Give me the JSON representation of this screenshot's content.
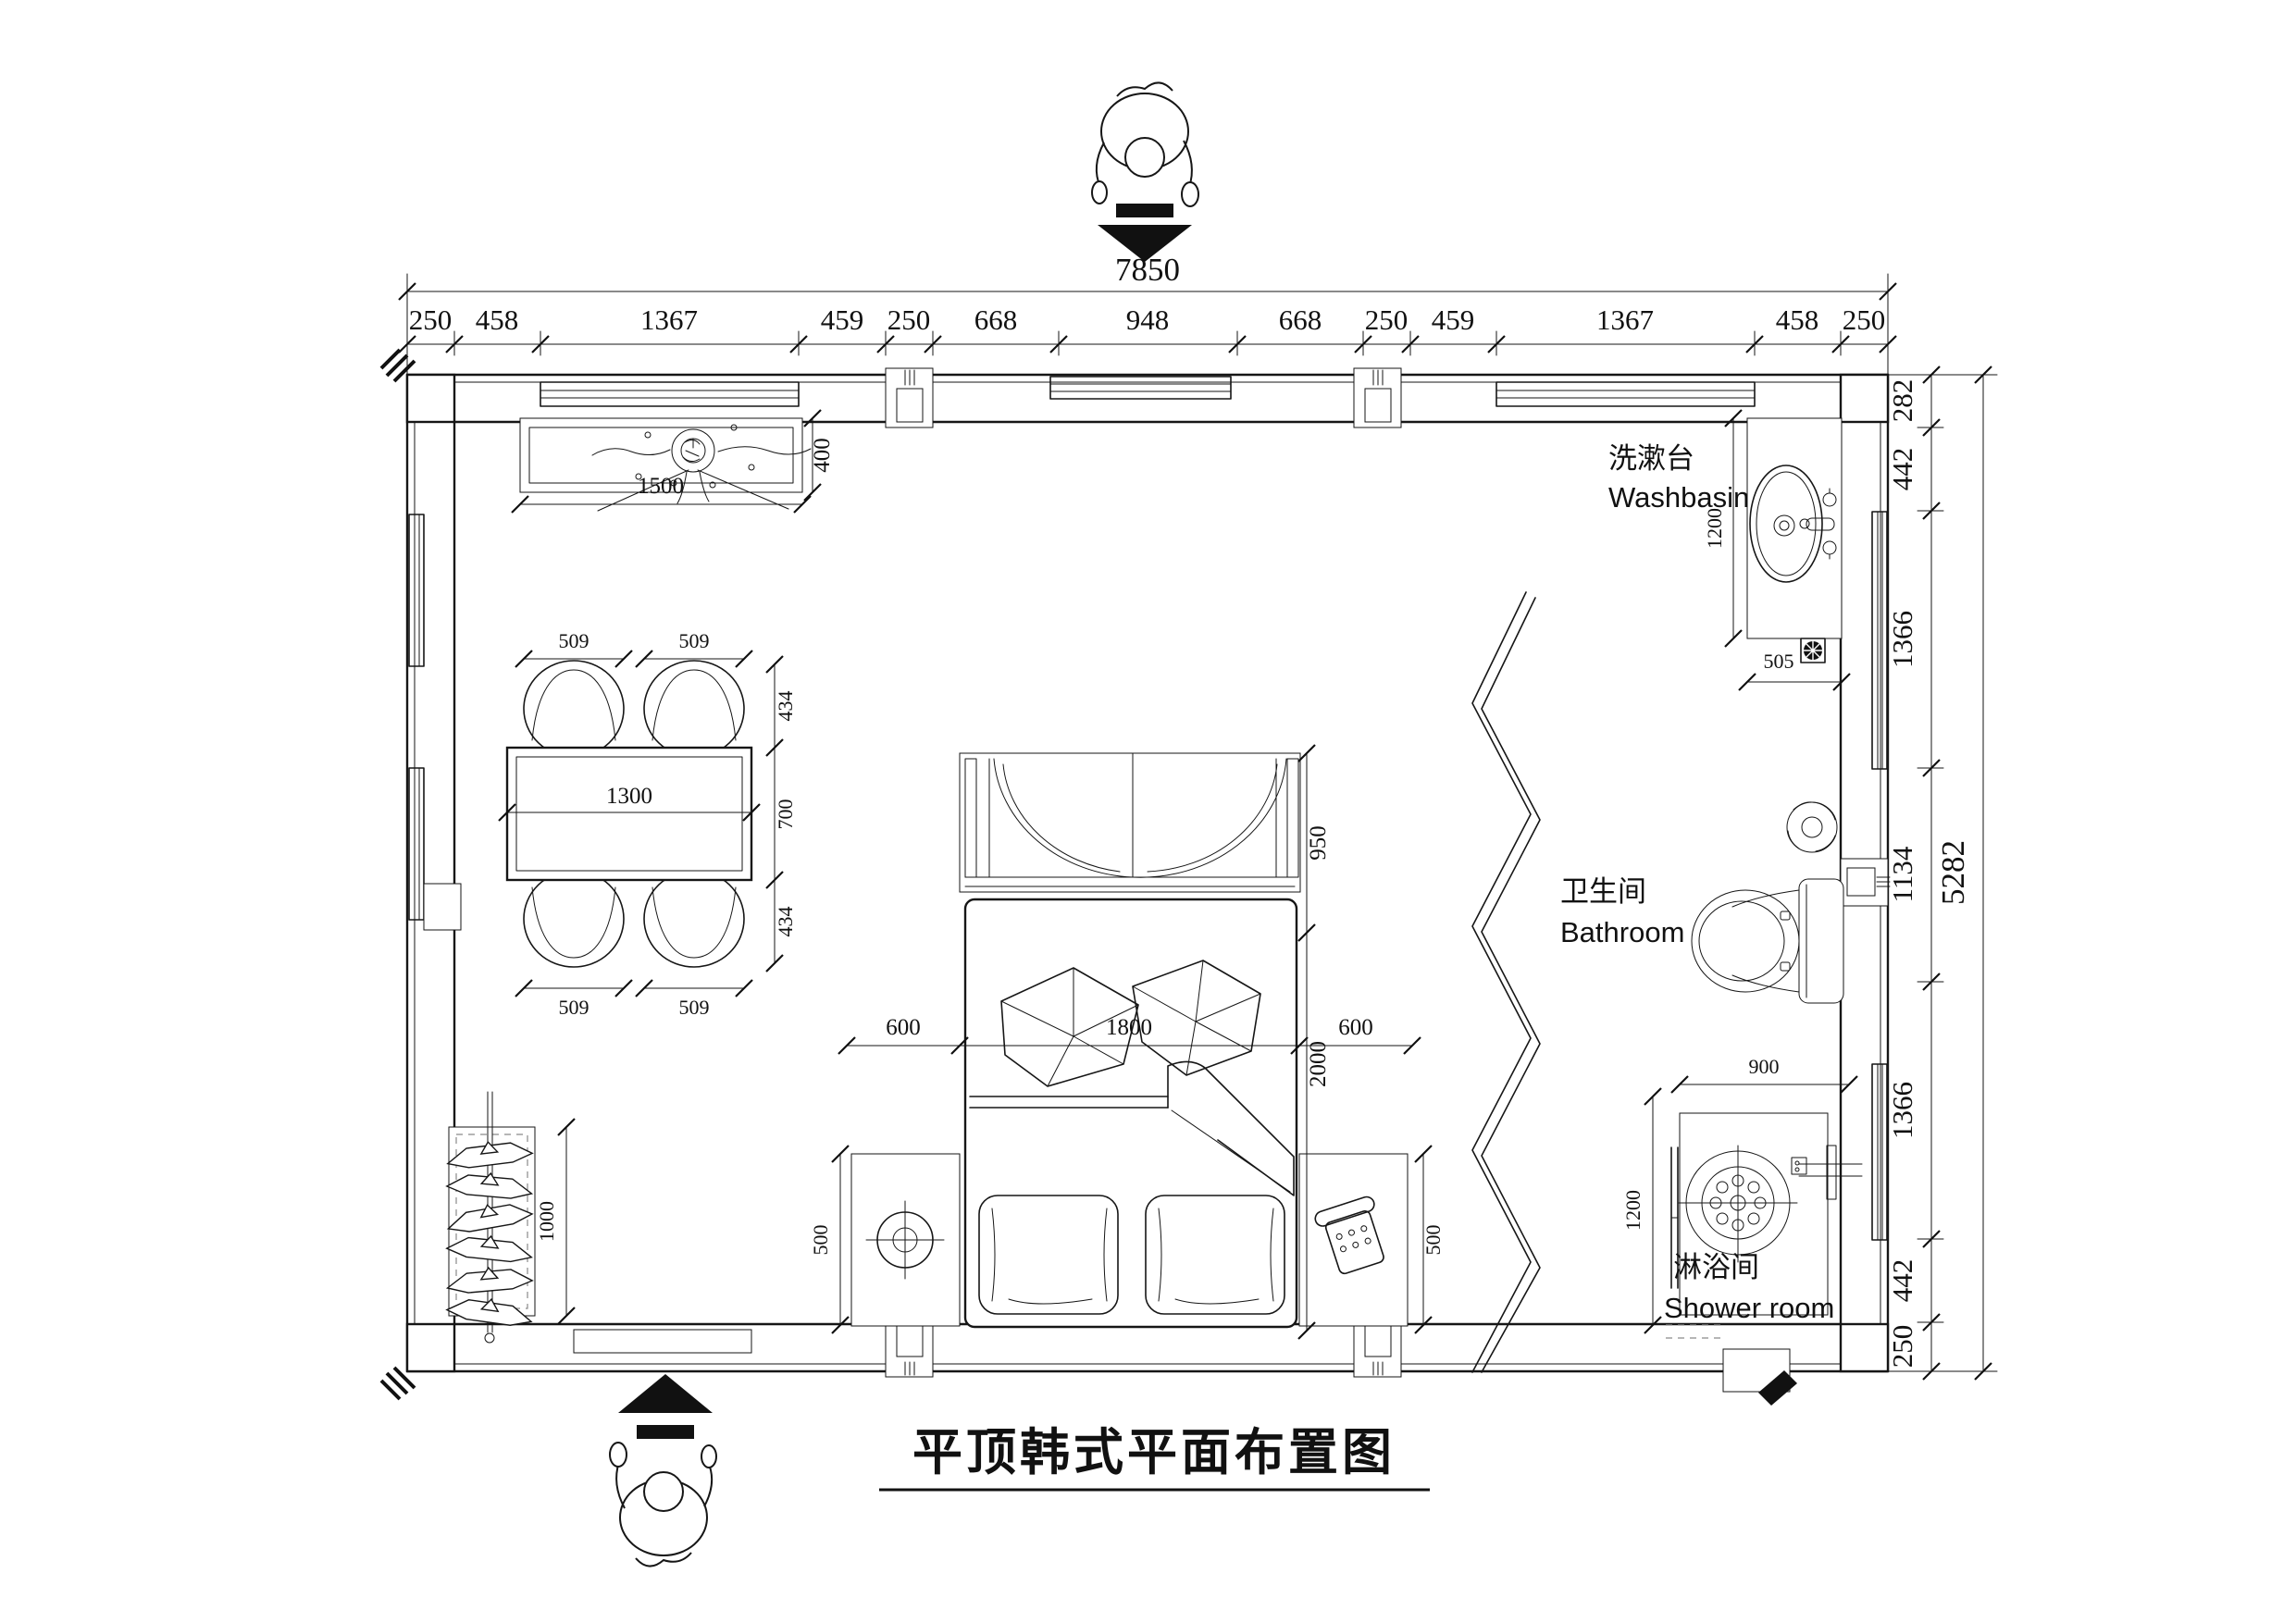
{
  "title": "平顶韩式平面布置图",
  "labels": {
    "washbasin_zh": "洗漱台",
    "washbasin_en": "Washbasin",
    "bathroom_zh": "卫生间",
    "bathroom_en": "Bathroom",
    "shower_zh": "淋浴间",
    "shower_en": "Shower room"
  },
  "dims": {
    "top_total": "7850",
    "top_segments": [
      "250",
      "458",
      "1367",
      "459",
      "250",
      "668",
      "948",
      "668",
      "250",
      "459",
      "1367",
      "458",
      "250"
    ],
    "right_total": "5282",
    "right_segments": [
      "282",
      "442",
      "1366",
      "1134",
      "1366",
      "442",
      "250"
    ],
    "console_w": "1500",
    "console_d": "400",
    "table_w": "1300",
    "table_d": "700",
    "chair_w_tl": "509",
    "chair_w_tr": "509",
    "chair_w_bl": "509",
    "chair_w_br": "509",
    "chair_d_top": "434",
    "chair_d_bottom": "434",
    "rack_l": "1000",
    "bed_w": "1800",
    "bed_l": "2000",
    "bed_head": "950",
    "nightstand_w_left": "600",
    "nightstand_w_right": "600",
    "nightstand_d_left": "500",
    "nightstand_d_right": "500",
    "basin_l": "1200",
    "basin_w": "505",
    "shower_w": "900",
    "shower_d": "1200"
  }
}
